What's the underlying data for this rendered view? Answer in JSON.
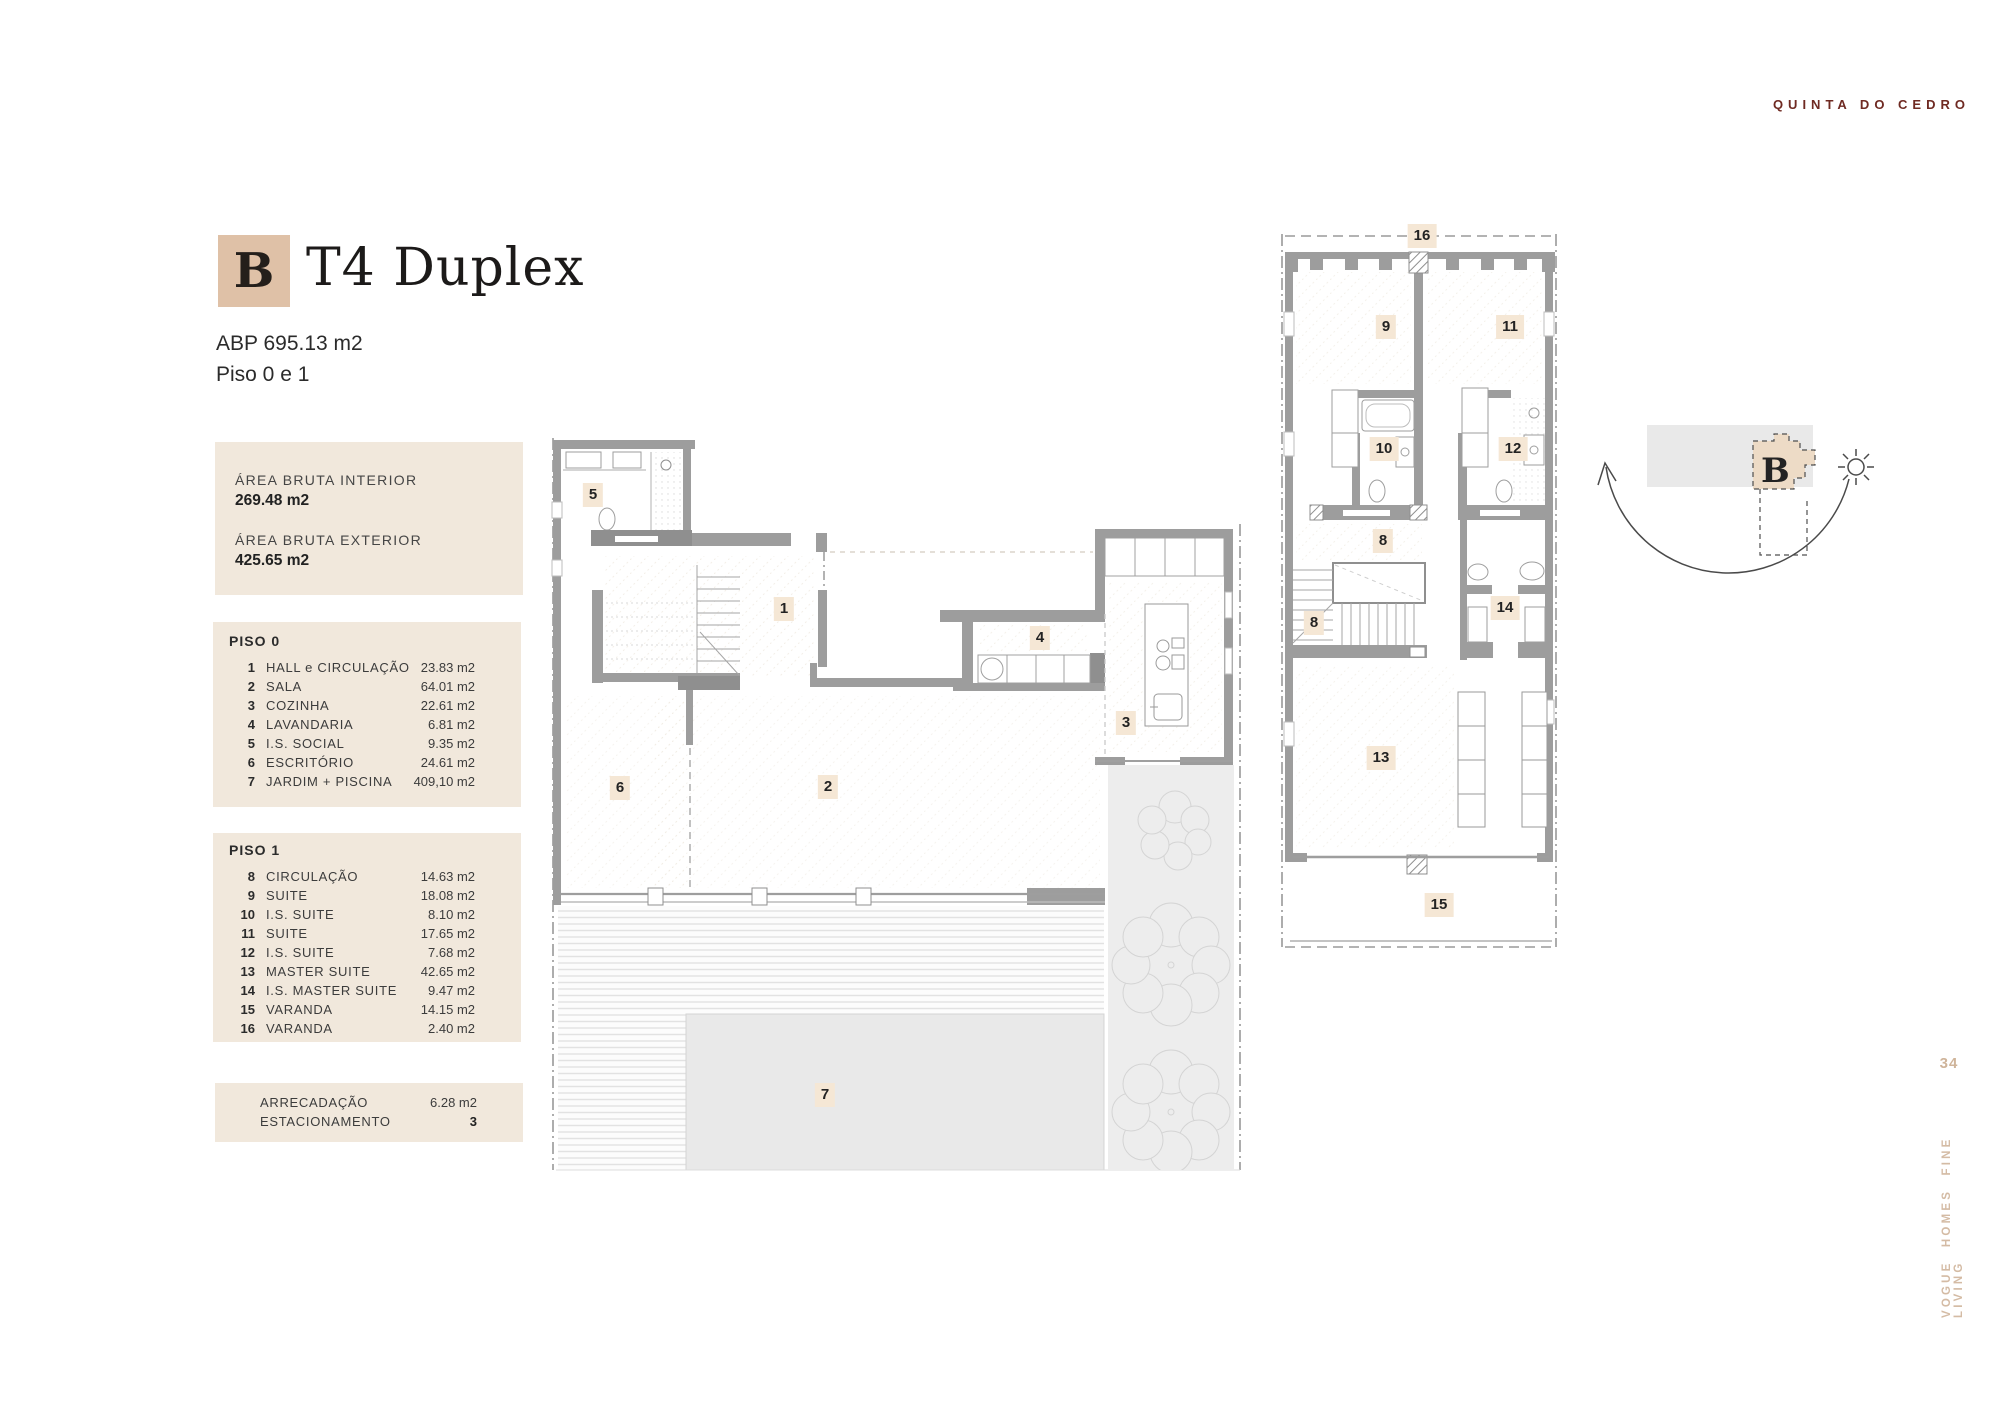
{
  "brand": {
    "project_name": "QUINTA DO CEDRO",
    "logo_letter": "B",
    "side_text": "VOGUE HOMES FINE LIVING",
    "page_number": "34"
  },
  "header": {
    "unit_type": "T4 Duplex",
    "abp": "ABP 695.13 m2",
    "floors": "Piso 0 e 1"
  },
  "areas": {
    "interior_label": "ÁREA BRUTA INTERIOR",
    "interior_value": "269.48 m2",
    "exterior_label": "ÁREA BRUTA EXTERIOR",
    "exterior_value": "425.65 m2"
  },
  "piso0": {
    "title": "PISO 0",
    "rooms": [
      {
        "num": "1",
        "name": "HALL e CIRCULAÇÃO",
        "area": "23.83 m2"
      },
      {
        "num": "2",
        "name": "SALA",
        "area": "64.01 m2"
      },
      {
        "num": "3",
        "name": "COZINHA",
        "area": "22.61 m2"
      },
      {
        "num": "4",
        "name": "LAVANDARIA",
        "area": "6.81 m2"
      },
      {
        "num": "5",
        "name": "I.S. SOCIAL",
        "area": "9.35 m2"
      },
      {
        "num": "6",
        "name": "ESCRITÓRIO",
        "area": "24.61 m2"
      },
      {
        "num": "7",
        "name": "JARDIM + PISCINA",
        "area": "409,10 m2"
      }
    ]
  },
  "piso1": {
    "title": "PISO 1",
    "rooms": [
      {
        "num": "8",
        "name": "CIRCULAÇÃO",
        "area": "14.63 m2"
      },
      {
        "num": "9",
        "name": "SUITE",
        "area": "18.08 m2"
      },
      {
        "num": "10",
        "name": "I.S. SUITE",
        "area": "8.10 m2"
      },
      {
        "num": "11",
        "name": "SUITE",
        "area": "17.65 m2"
      },
      {
        "num": "12",
        "name": "I.S. SUITE",
        "area": "7.68 m2"
      },
      {
        "num": "13",
        "name": "MASTER SUITE",
        "area": "42.65 m2"
      },
      {
        "num": "14",
        "name": "I.S. MASTER SUITE",
        "area": "9.47 m2"
      },
      {
        "num": "15",
        "name": "VARANDA",
        "area": "14.15 m2"
      },
      {
        "num": "16",
        "name": "VARANDA",
        "area": "2.40 m2"
      }
    ]
  },
  "extras": {
    "rows": [
      {
        "name": "ARRECADAÇÃO",
        "value": "6.28 m2"
      },
      {
        "name": "ESTACIONAMENTO",
        "value": "3"
      }
    ]
  },
  "plan_badges": {
    "piso0": [
      "5",
      "1",
      "4",
      "3",
      "2",
      "6",
      "7"
    ],
    "piso1": [
      "16",
      "9",
      "11",
      "10",
      "12",
      "8",
      "8",
      "14",
      "13",
      "15"
    ]
  },
  "colors": {
    "accent_beige": "#f1e8dc",
    "logo_tan": "#dfc1a7",
    "maroon": "#6f2a22",
    "badge_tan": "#f5e7d5",
    "side_text_tan": "#d4bba4",
    "wall_gray": "#9d9d9d"
  }
}
